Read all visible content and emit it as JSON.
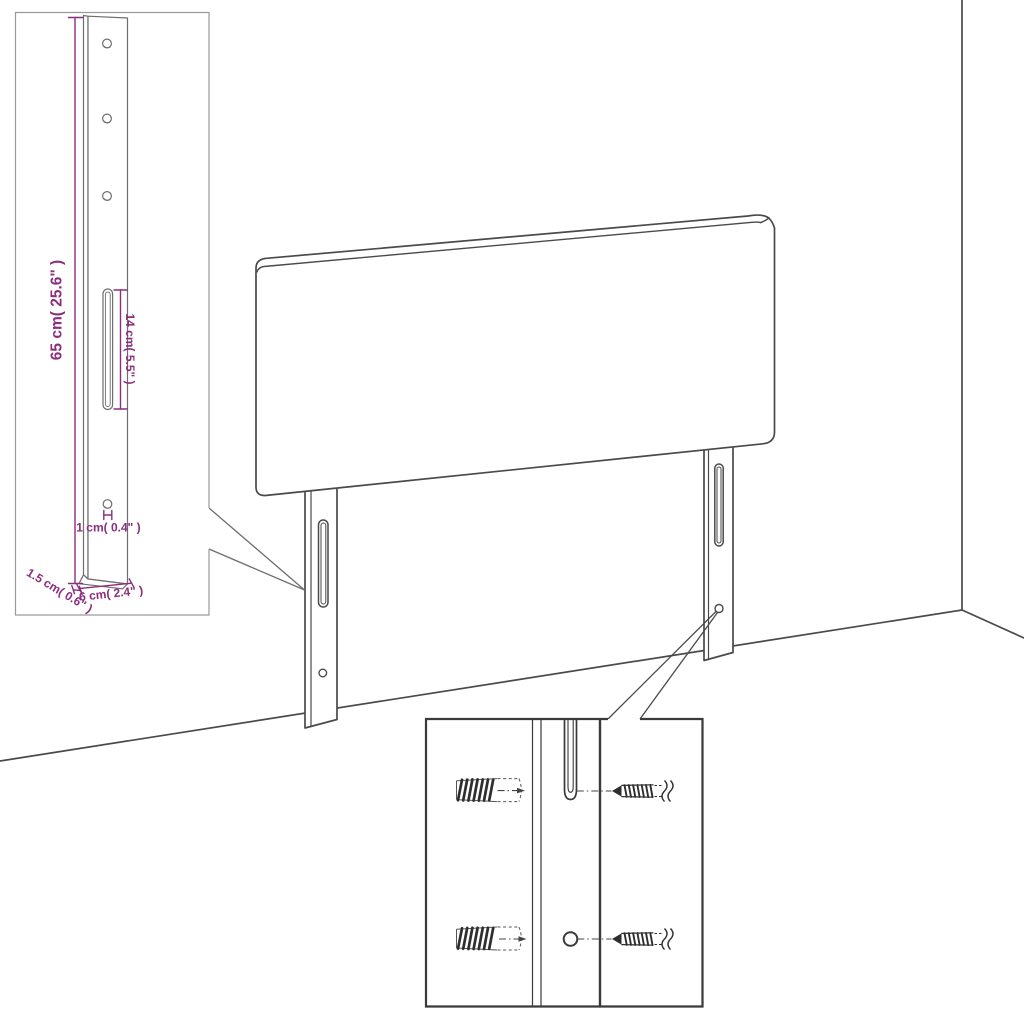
{
  "figure": {
    "type": "assembly-dimension-diagram",
    "subject": "upholstered headboard with two mounting legs, wall corner scene, leg dimension inset and screw/wall-plug detail inset"
  },
  "colors": {
    "background": "#ffffff",
    "main_outline": "#4a4a4a",
    "inset_profile_outline": "#6e6e6e",
    "dimension_inset_border": "#9a9a9a",
    "detail_inset_border": "#3a3a3a",
    "dimension_accent": "#8b2e7c",
    "hardware_dark": "#2e2e2e"
  },
  "dimensions": {
    "leg_height": "65 cm( 25.6\" )",
    "slot_length": "14 cm( 5.5\" )",
    "hole_diameter": "1 cm( 0.4\" )",
    "leg_width": "6 cm( 2.4\" )",
    "leg_thickness": "1.5 cm( 0.6\" )"
  },
  "icons": {
    "wall_plug": "hatched-wall-anchor",
    "screw": "pointed-threaded-screw-with-break-symbol"
  }
}
